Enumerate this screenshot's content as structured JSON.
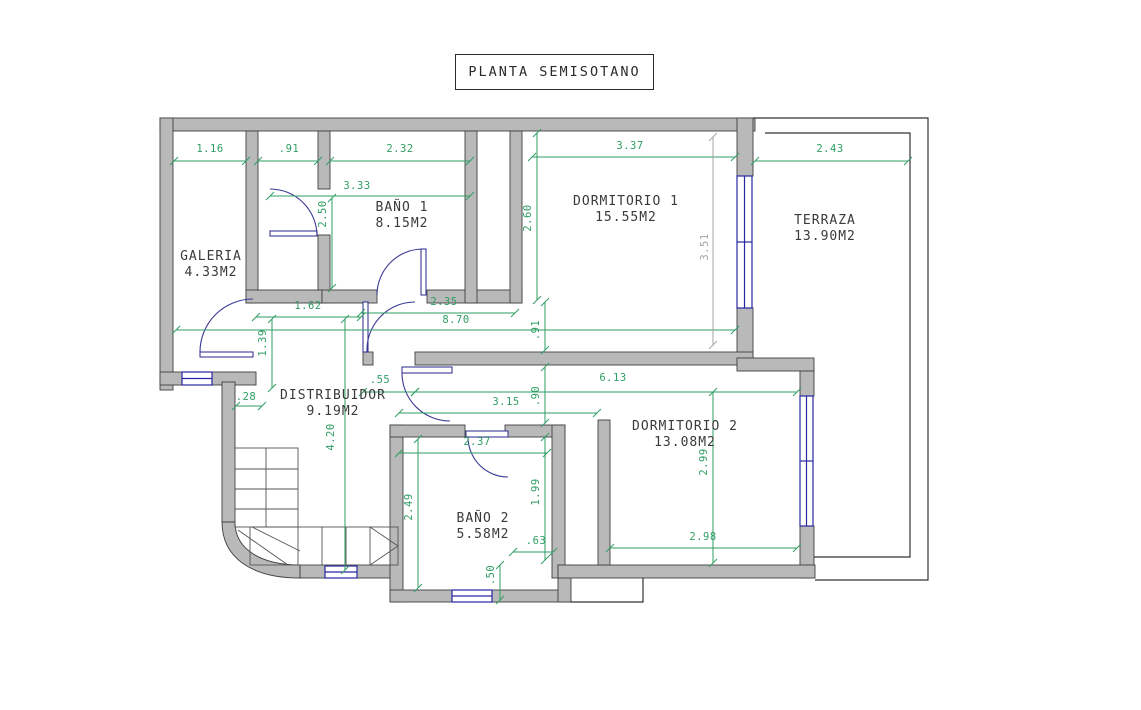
{
  "title": {
    "label": "PLANTA SEMISOTANO"
  },
  "colors": {
    "dimension_green": "#2f9e63",
    "dimension_gray": "#a6a6a6",
    "wall_fill": "#b9b9b9",
    "wall_line": "#3f3f3f",
    "window_blue": "#2727a3",
    "door_blue": "#3a3a96",
    "stair_line": "#555555",
    "terrace_line": "#333333"
  },
  "rooms": [
    {
      "name": "GALERIA",
      "area": "4.33M2",
      "x": 211,
      "y": 265
    },
    {
      "name": "BAÑO 1",
      "area": "8.15M2",
      "x": 402,
      "y": 216
    },
    {
      "name": "DORMITORIO 1",
      "area": "15.55M2",
      "x": 626,
      "y": 210
    },
    {
      "name": "TERRAZA",
      "area": "13.90M2",
      "x": 825,
      "y": 229
    },
    {
      "name": "DISTRIBUIDOR",
      "area": "9.19M2",
      "x": 333,
      "y": 404
    },
    {
      "name": "DORMITORIO 2",
      "area": "13.08M2",
      "x": 685,
      "y": 435
    },
    {
      "name": "BAÑO 2",
      "area": "5.58M2",
      "x": 483,
      "y": 527
    }
  ],
  "dimensions": [
    {
      "value": "1.16",
      "x": 210,
      "y": 149,
      "rot": false,
      "line": [
        174,
        161,
        246,
        161
      ]
    },
    {
      "value": ".91",
      "x": 289,
      "y": 149,
      "rot": false,
      "line": [
        258,
        161,
        318,
        161
      ]
    },
    {
      "value": "2.32",
      "x": 400,
      "y": 149,
      "rot": false,
      "line": [
        330,
        161,
        470,
        161
      ]
    },
    {
      "value": "3.37",
      "x": 630,
      "y": 146,
      "rot": false,
      "line": [
        532,
        157,
        735,
        157
      ]
    },
    {
      "value": "2.43",
      "x": 830,
      "y": 149,
      "rot": false,
      "line": [
        755,
        161,
        908,
        161
      ]
    },
    {
      "value": "3.33",
      "x": 357,
      "y": 186,
      "rot": false,
      "line": [
        270,
        196,
        470,
        196
      ]
    },
    {
      "value": "1.62",
      "x": 308,
      "y": 306,
      "rot": false,
      "line": [
        256,
        317,
        361,
        317
      ]
    },
    {
      "value": "2.35",
      "x": 444,
      "y": 302,
      "rot": false,
      "line": [
        361,
        313,
        515,
        313
      ]
    },
    {
      "value": "8.70",
      "x": 456,
      "y": 320,
      "rot": false,
      "line": [
        176,
        330,
        735,
        330
      ]
    },
    {
      "value": ".55",
      "x": 380,
      "y": 380,
      "rot": false,
      "line": [
        363,
        392,
        415,
        392
      ]
    },
    {
      "value": "6.13",
      "x": 613,
      "y": 378,
      "rot": false,
      "line": [
        415,
        392,
        797,
        392
      ]
    },
    {
      "value": "3.15",
      "x": 506,
      "y": 402,
      "rot": false,
      "line": [
        399,
        413,
        597,
        413
      ]
    },
    {
      "value": "2.37",
      "x": 477,
      "y": 442,
      "rot": false,
      "line": [
        399,
        453,
        547,
        453
      ]
    },
    {
      "value": ".63",
      "x": 536,
      "y": 541,
      "rot": false,
      "line": [
        513,
        552,
        553,
        552
      ]
    },
    {
      "value": "2.98",
      "x": 703,
      "y": 537,
      "rot": false,
      "line": [
        610,
        548,
        797,
        548
      ]
    },
    {
      "value": ".28",
      "x": 246,
      "y": 397,
      "rot": false,
      "line": [
        236,
        406,
        262,
        406
      ]
    },
    {
      "value": "2.50",
      "x": 323,
      "y": 214,
      "rot": true,
      "line": [
        332,
        198,
        332,
        288
      ]
    },
    {
      "value": "2.60",
      "x": 528,
      "y": 218,
      "rot": true,
      "line": [
        537,
        133,
        537,
        300
      ]
    },
    {
      "value": "3.51",
      "x": 705,
      "y": 247,
      "rot": true,
      "gray": true,
      "line": [
        713,
        137,
        713,
        345
      ]
    },
    {
      "value": "1.39",
      "x": 263,
      "y": 343,
      "rot": true,
      "line": [
        272,
        319,
        272,
        388
      ]
    },
    {
      "value": ".91",
      "x": 536,
      "y": 330,
      "rot": true,
      "line": [
        545,
        302,
        545,
        350
      ]
    },
    {
      "value": ".90",
      "x": 536,
      "y": 396,
      "rot": true,
      "line": [
        545,
        367,
        545,
        423
      ]
    },
    {
      "value": "4.20",
      "x": 331,
      "y": 437,
      "rot": true,
      "line": [
        345,
        319,
        345,
        570
      ]
    },
    {
      "value": "2.49",
      "x": 409,
      "y": 507,
      "rot": true,
      "line": [
        418,
        439,
        418,
        588
      ]
    },
    {
      "value": "1.99",
      "x": 536,
      "y": 492,
      "rot": true,
      "line": [
        545,
        437,
        545,
        560
      ]
    },
    {
      "value": ".50",
      "x": 491,
      "y": 575,
      "rot": true,
      "line": [
        500,
        565,
        500,
        600
      ]
    },
    {
      "value": "2.99",
      "x": 704,
      "y": 462,
      "rot": true,
      "line": [
        713,
        392,
        713,
        563
      ]
    }
  ]
}
